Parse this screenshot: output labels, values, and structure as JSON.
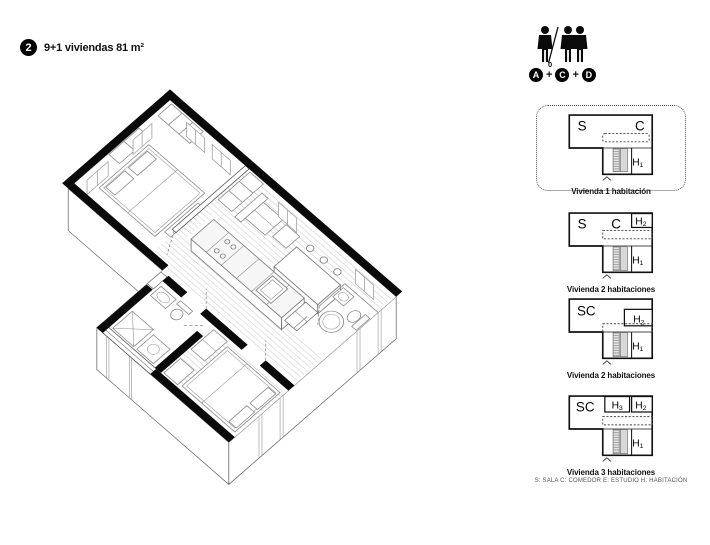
{
  "header": {
    "badge": "2",
    "title": "9+1 viviendas 81 m²"
  },
  "occupancy": {
    "superscript": "0",
    "plus1": "+",
    "plus2": "+",
    "badge_a": "A",
    "badge_c": "C",
    "badge_d": "D"
  },
  "legend": {
    "items": [
      {
        "s": "S",
        "c": "C",
        "h1b": "H",
        "h1s": "1",
        "caption": "Vivienda 1 habitación"
      },
      {
        "s": "S",
        "c": "C",
        "h2b": "H",
        "h2s": "2",
        "h1b": "H",
        "h1s": "1",
        "caption": "Vivienda 2 habitaciones"
      },
      {
        "sc": "SC",
        "h2b": "H",
        "h2s": "2",
        "h1b": "H",
        "h1s": "1",
        "caption": "Vivienda 2 habitaciones"
      },
      {
        "sc": "SC",
        "h3b": "H",
        "h3s": "3",
        "h2b": "H",
        "h2s": "2",
        "h1b": "H",
        "h1s": "1",
        "caption": "Vivienda 3 habitaciones"
      }
    ],
    "footnote": "S: SALA   C: COMEDOR   E: ESTUDIO   H: HABITACIÓN"
  }
}
